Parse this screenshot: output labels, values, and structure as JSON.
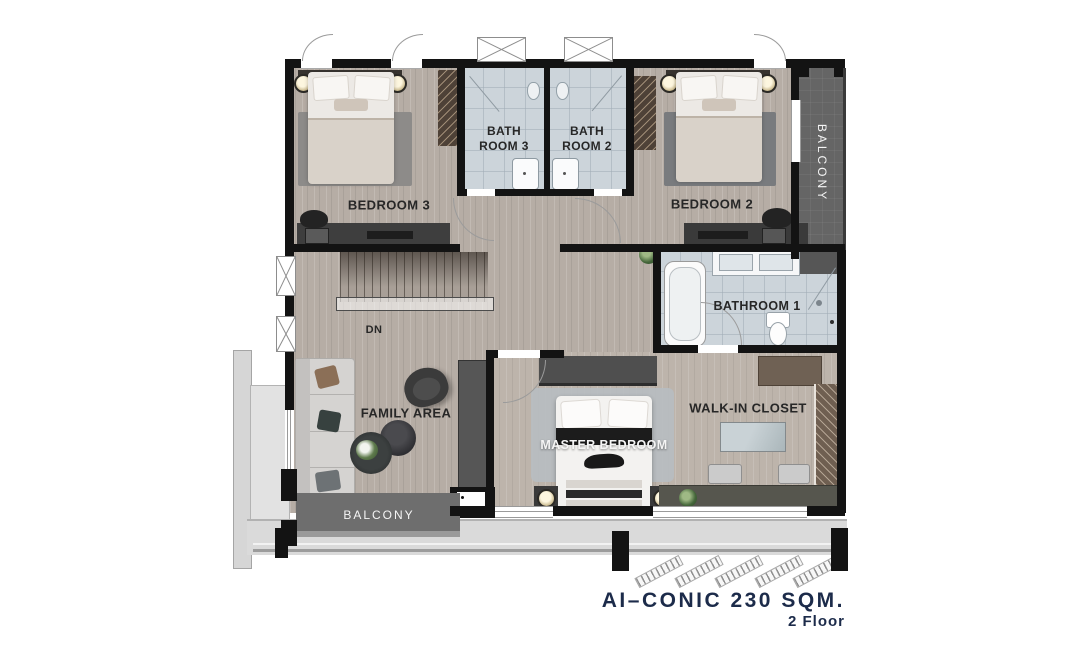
{
  "document": {
    "type": "floor-plan",
    "floor_plan_name": "AI-CONIC",
    "area": "230 SQM.",
    "floor": "2 Floor"
  },
  "rooms": {
    "bedroom3": {
      "label": "BEDROOM 3"
    },
    "bathroom3": {
      "line1": "BATH",
      "line2": "ROOM 3"
    },
    "bathroom2": {
      "line1": "BATH",
      "line2": "ROOM 2"
    },
    "bedroom2": {
      "label": "BEDROOM 2"
    },
    "balcony_right": {
      "label": "BALCONY"
    },
    "bathroom1": {
      "label": "BATHROOM 1"
    },
    "stairs": {
      "dn_label": "DN"
    },
    "family_area": {
      "label": "FAMILY AREA"
    },
    "master_bedroom": {
      "label": "MASTER BEDROOM"
    },
    "walk_in_closet": {
      "label": "WALK-IN CLOSET"
    },
    "balcony_bottom": {
      "label": "BALCONY"
    }
  },
  "footer": {
    "title": "AI–CONIC 230 SQM.",
    "subtitle": "2 Floor"
  },
  "colors": {
    "title_text": "#1c2b4a",
    "wall": "#131313",
    "wood_floor": "#b6ada5",
    "tile_floor": "#ccd4da",
    "balcony_dark": "#656565",
    "wardrobe_brown": "#4e4137",
    "exterior_gray": "#d9d9d9"
  }
}
